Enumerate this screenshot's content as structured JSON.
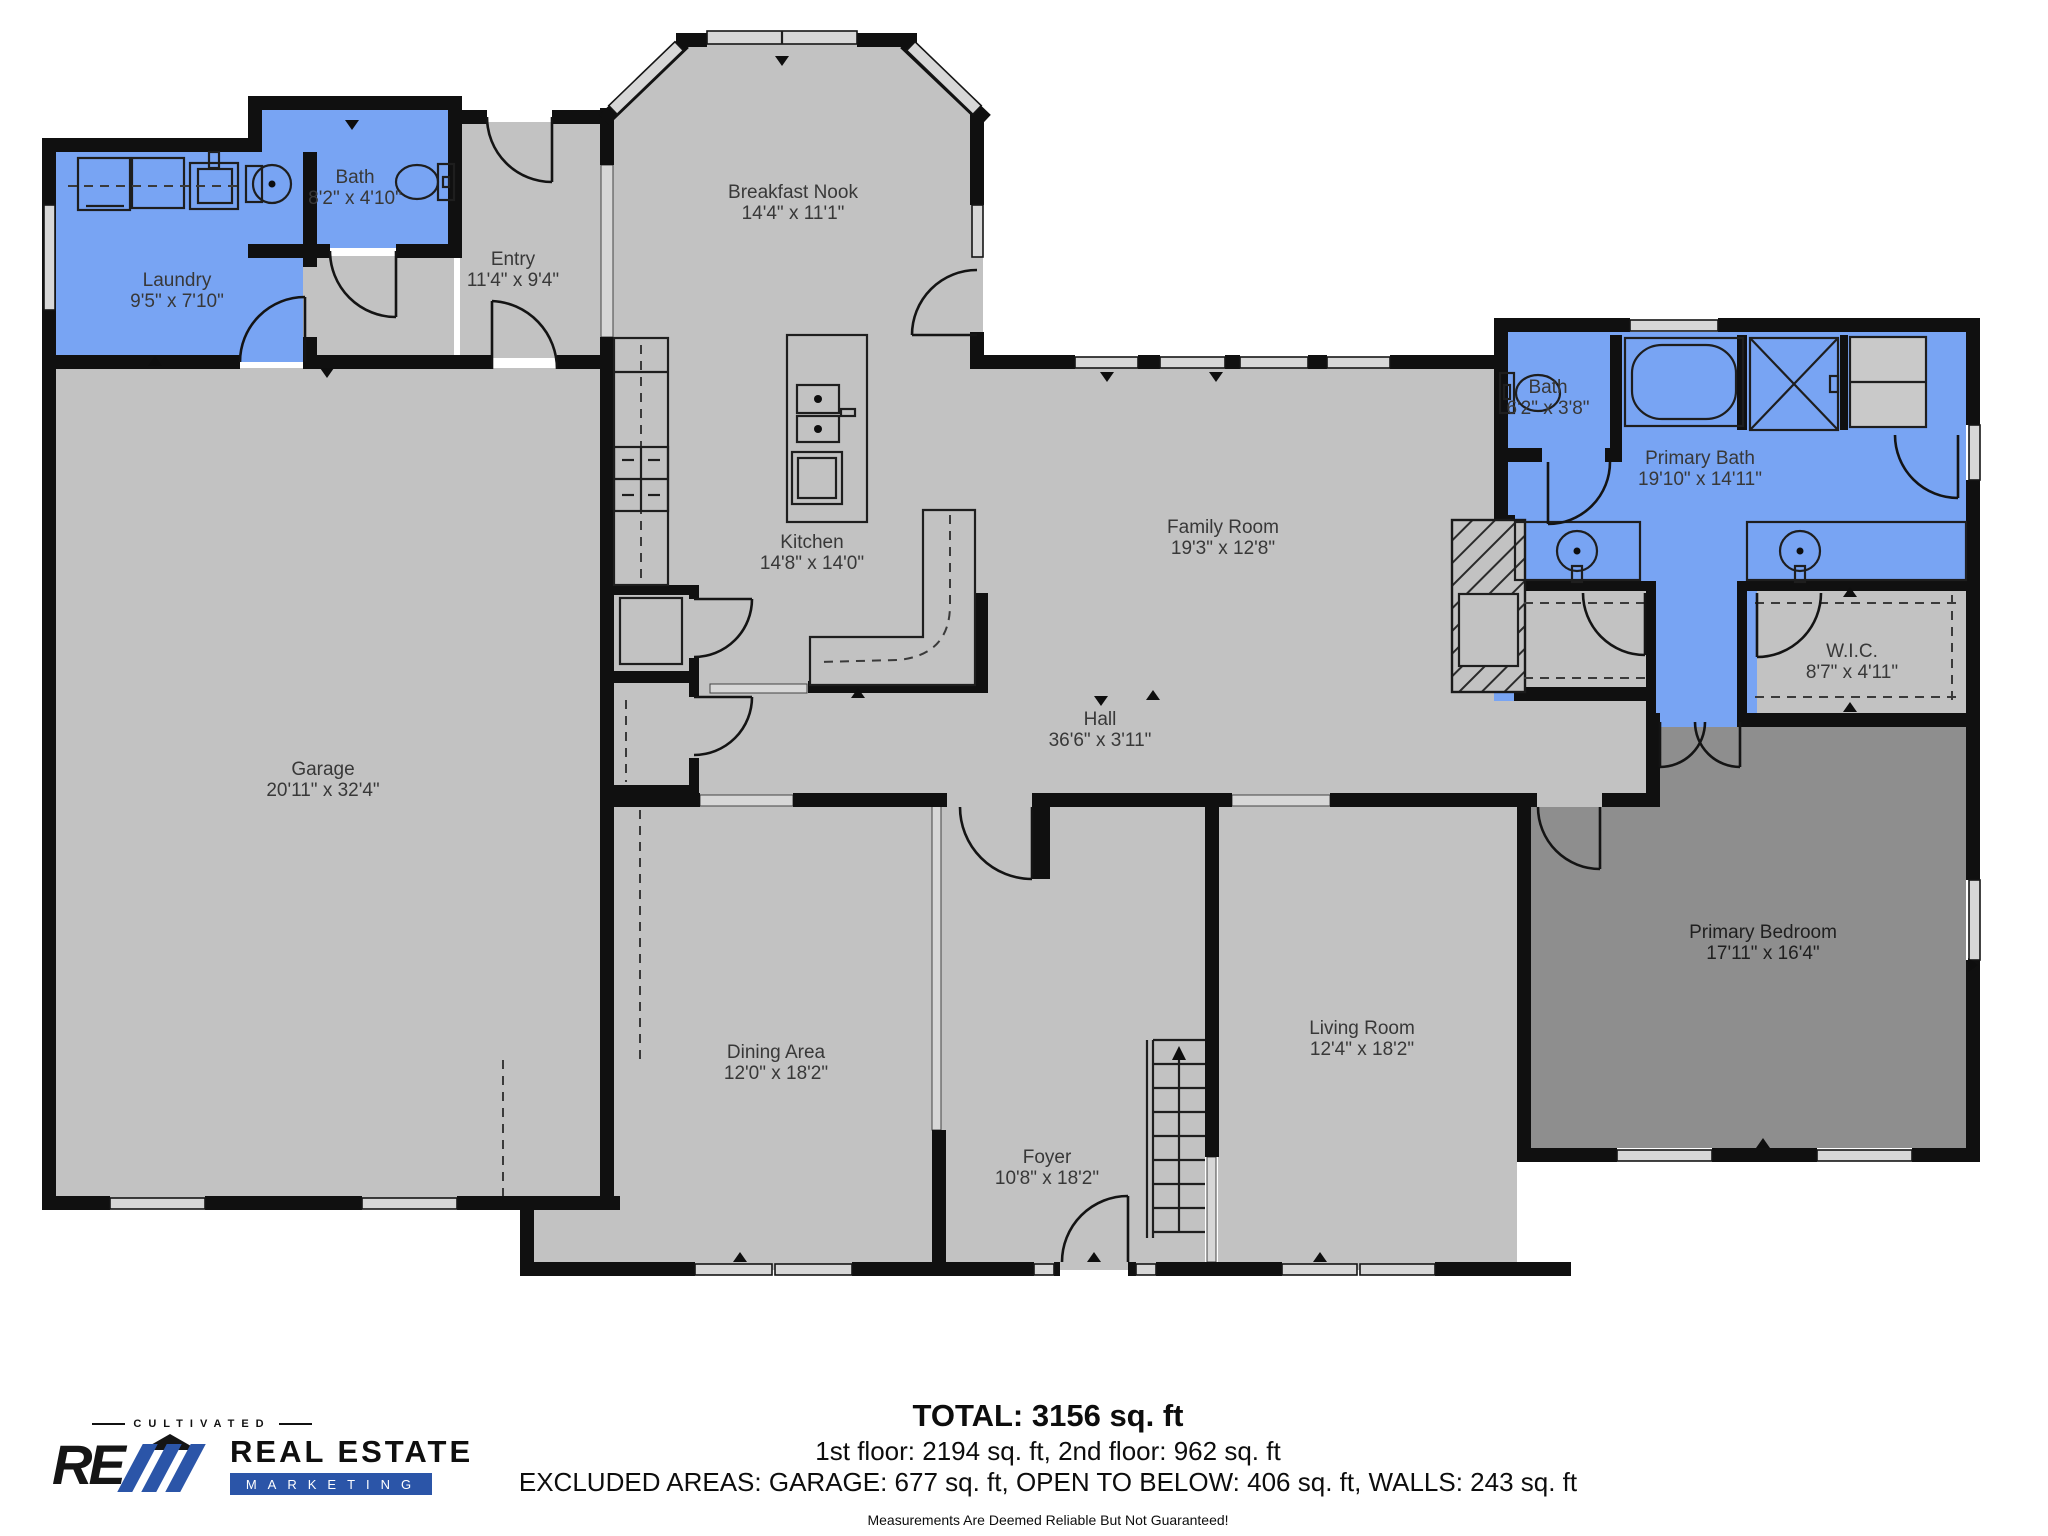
{
  "rooms": {
    "laundry": {
      "name": "Laundry",
      "dims": "9'5\" x 7'10\""
    },
    "bath1": {
      "name": "Bath",
      "dims": "8'2\" x 4'10\""
    },
    "entry": {
      "name": "Entry",
      "dims": "11'4\" x 9'4\""
    },
    "breakfast_nook": {
      "name": "Breakfast Nook",
      "dims": "14'4\" x 11'1\""
    },
    "kitchen": {
      "name": "Kitchen",
      "dims": "14'8\" x 14'0\""
    },
    "family_room": {
      "name": "Family Room",
      "dims": "19'3\" x 12'8\""
    },
    "garage": {
      "name": "Garage",
      "dims": "20'11\" x 32'4\""
    },
    "hall": {
      "name": "Hall",
      "dims": "36'6\" x 3'11\""
    },
    "bath2": {
      "name": "Bath",
      "dims": "6'2\" x 3'8\""
    },
    "primary_bath": {
      "name": "Primary Bath",
      "dims": "19'10\" x 14'11\""
    },
    "wic": {
      "name": "W.I.C.",
      "dims": "8'7\" x 4'11\""
    },
    "dining": {
      "name": "Dining Area",
      "dims": "12'0\" x 18'2\""
    },
    "foyer": {
      "name": "Foyer",
      "dims": "10'8\" x 18'2\""
    },
    "living": {
      "name": "Living Room",
      "dims": "12'4\" x 18'2\""
    },
    "primary_bedroom": {
      "name": "Primary Bedroom",
      "dims": "17'11\" x 16'4\""
    }
  },
  "summary": {
    "total": "TOTAL: 3156 sq. ft",
    "floors": "1st floor: 2194 sq. ft, 2nd floor: 962 sq. ft",
    "excluded": "EXCLUDED AREAS: GARAGE: 677 sq. ft, OPEN TO BELOW: 406 sq. ft, WALLS: 243 sq. ft",
    "disclaimer": "Measurements Are Deemed Reliable But Not Guaranteed!"
  },
  "branding": {
    "cultivated": "CULTIVATED",
    "monogram": "RE",
    "brand_line1": "REAL ESTATE",
    "brand_line2": "MARKETING"
  },
  "colors": {
    "floor": "#c2c2c2",
    "bedroom": "#8e8e8e",
    "blue": "#78a4f3",
    "wall": "#101010",
    "window": "#d7d7d7",
    "logo": "#2b55a8"
  }
}
